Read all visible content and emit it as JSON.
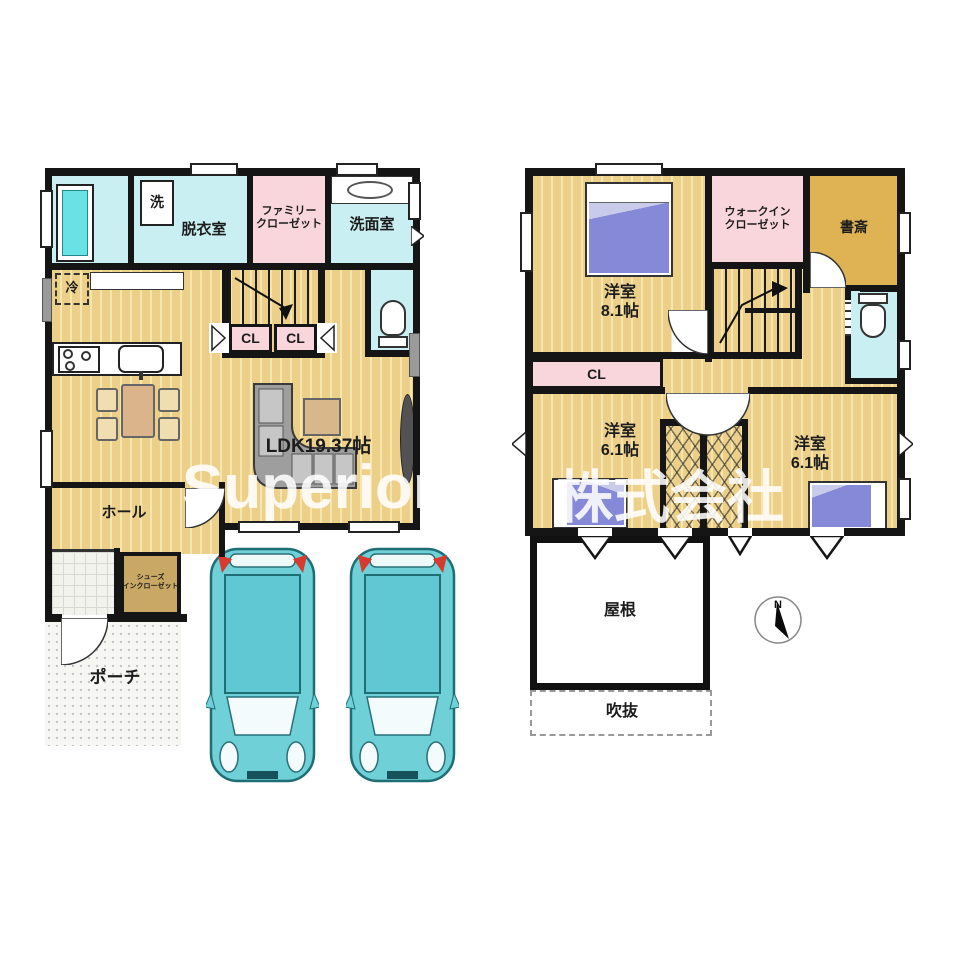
{
  "watermark": {
    "left": "Superior",
    "right": "株式会社"
  },
  "floor1": {
    "laundry": "洗",
    "dressing_room": "脱衣室",
    "family_closet": "ファミリー\nクローゼット",
    "washroom": "洗面室",
    "fridge": "冷",
    "closet1": "CL",
    "closet2": "CL",
    "ldk": "LDK19.37帖",
    "hall": "ホール",
    "shoe_closet": "シューズ\nインクローゼット",
    "porch": "ポーチ"
  },
  "floor2": {
    "bedroom1": "洋室\n8.1帖",
    "walk_in_closet": "ウォークイン\nクローゼット",
    "study": "書斎",
    "closet": "CL",
    "bedroom2": "洋室\n6.1帖",
    "bedroom3": "洋室\n6.1帖",
    "roof": "屋根",
    "void": "吹抜",
    "compass_north": "N"
  },
  "colors": {
    "wall": "#151515",
    "floor_wood_base": "#ecd08a",
    "floor_wood_stripe": "#f7e5ae",
    "wet_room_teal": "#c9eff2",
    "bathtub_teal": "#69e2e6",
    "closet_pink": "#f9d6db",
    "study_gold": "#dfb254",
    "shoe_closet_tan": "#c9a765",
    "bed_purple": "#8688d8",
    "car_teal": "#6fd0d8",
    "watermark_white": "rgba(255,255,255,0.87)"
  }
}
